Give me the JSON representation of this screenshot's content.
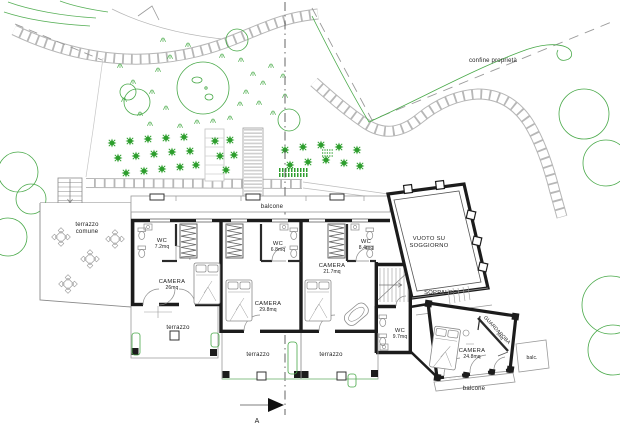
{
  "drawing_title": "planimetria piano primo",
  "site": {
    "boundary_label": "confine proprietà",
    "section_marker": "A"
  },
  "labels": {
    "confine": "confine proprietà",
    "balcone_top": "balcone",
    "terrazzo_comune_1": "terrazzo",
    "terrazzo_comune_2": "comune",
    "wc1_name": "WC",
    "wc1_area": "7.2mq",
    "camera1_name": "CAMERA",
    "camera1_area": "26mq",
    "wc2_name": "WC",
    "wc2_area": "6.8mq",
    "camera2_name": "CAMERA",
    "camera2_area": "29.8mq",
    "wc3_name": "WC",
    "wc3_area": "8.4mq",
    "camera3_name": "CAMERA",
    "camera3_area": "21.7mq",
    "wc4_name": "WC",
    "wc4_area": "9.7mq",
    "vuoto_1": "VUOTO SU",
    "vuoto_2": "SOGGIORNO",
    "soppalco": "SOPPALCO",
    "guardaroba_name": "GUARDAROBA",
    "guardaroba_area": "5mq",
    "camera4_name": "CAMERA",
    "camera4_area": "24.8mq",
    "terrazzo_left": "terrazzo",
    "terrazzo_mid": "terrazzo",
    "terrazzo_right": "terrazzo",
    "balc_small": "balc.",
    "balcone_bottom": "balcone",
    "section_a": "A"
  },
  "colors": {
    "vegetation": "#3fa43f",
    "orchard": "#2d9e2d",
    "site_lines": "#bcbcbc",
    "walls": "#1c1c1c",
    "furniture": "#8a8a8a",
    "boundary_dash": "#9a9a9a"
  }
}
